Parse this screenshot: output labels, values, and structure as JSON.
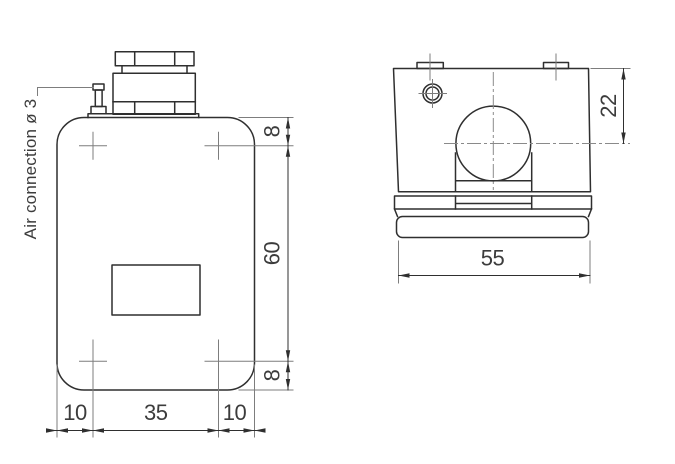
{
  "drawing": {
    "label_air_connection": "Air connection ø 3",
    "front_view": {
      "dim_top_offset": "8",
      "dim_body_height": "60",
      "dim_bottom_offset": "8",
      "dim_left_inset": "10",
      "dim_center_width": "35",
      "dim_right_inset": "10"
    },
    "side_view": {
      "dim_bore_center_depth": "22",
      "dim_width": "55"
    },
    "colors": {
      "outline": "#2f2f2f",
      "thin_line": "#7d7d7d",
      "text": "#3c3c3c",
      "background": "#ffffff"
    }
  }
}
